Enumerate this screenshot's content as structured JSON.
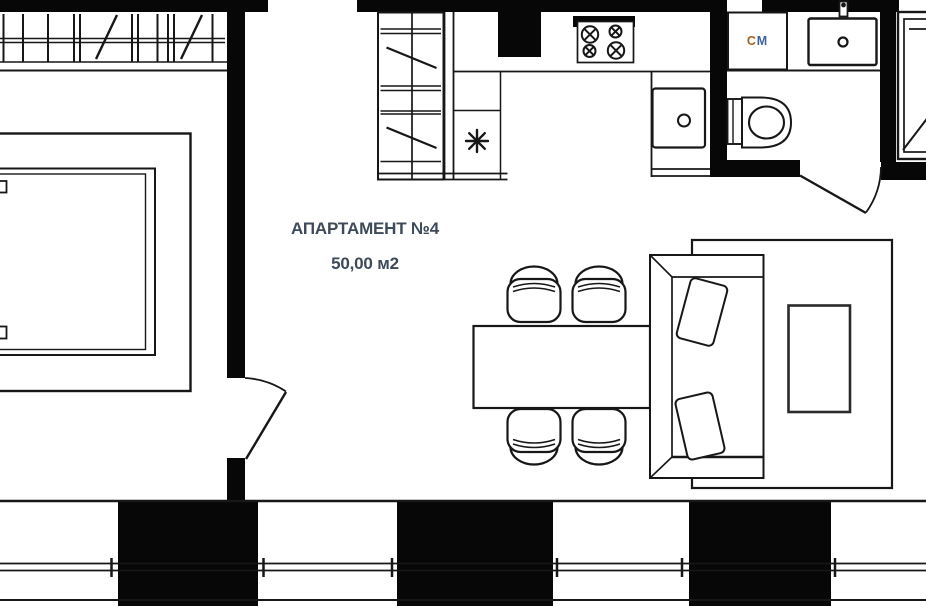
{
  "plan": {
    "title": "АПАРТАМЕНТ №4",
    "area": "50,00 м2",
    "labels": {
      "washing_machine_letter_1": "С",
      "washing_machine_letter_2": "М"
    },
    "colors": {
      "background": "#ffffff",
      "walls": "#070707",
      "linework": "#171717",
      "title_text": "#3d4a59",
      "washing_machine_c": "#a8611c",
      "washing_machine_m": "#3e639c"
    },
    "symbols": [
      "window-band-icon",
      "structural-column-icon",
      "bed-icon",
      "door-swing-icon",
      "wardrobe-icon",
      "refrigerator-snowflake-icon",
      "stove-4-burners-icon",
      "kitchen-sink-icon",
      "washing-machine-icon",
      "washbasin-icon",
      "faucet-icon",
      "toilet-icon",
      "shower-tray-icon",
      "dining-table-icon",
      "chair-icon",
      "sofa-icon",
      "pillow-icon",
      "coffee-table-icon",
      "rug-icon",
      "balcony-rail-icon"
    ]
  }
}
